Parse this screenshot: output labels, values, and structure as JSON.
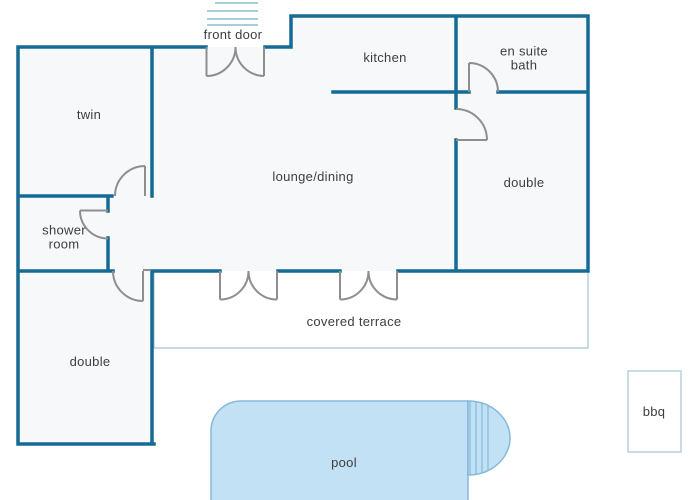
{
  "colors": {
    "wall": "#176a94",
    "door": "#8e8e8e",
    "steps": "#a7cedd",
    "terrace": "#b0cedd",
    "pool_fill": "#c3e1f4",
    "pool_border": "#86b9da",
    "room_fill": "#f6f8f9",
    "text": "#3e3e3e",
    "background": "#ffffff"
  },
  "rooms": {
    "twin": "twin",
    "shower_room": "shower room",
    "double_left": "double",
    "lounge_dining": "lounge/dining",
    "kitchen": "kitchen",
    "en_suite_bath": "en suite bath",
    "double_right": "double"
  },
  "outdoor": {
    "front_door": "front door",
    "covered_terrace": "covered terrace",
    "pool": "pool",
    "bbq": "bbq"
  }
}
